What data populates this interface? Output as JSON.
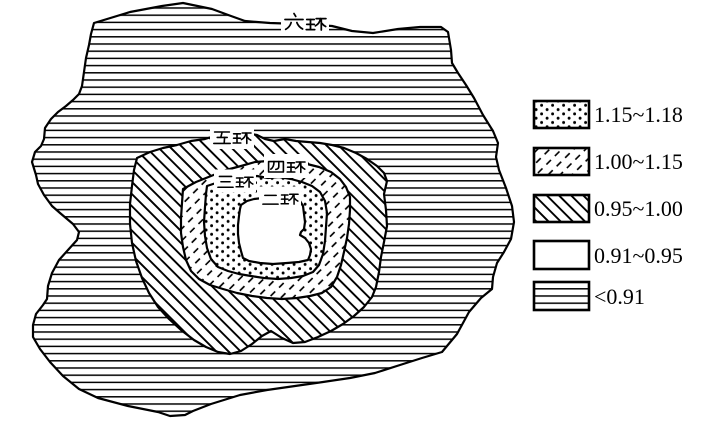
{
  "figure": {
    "type": "thematic-ring-road-map",
    "description": "Schematic map of concentric ring-road zones filled with hatch patterns keyed to a legend of value classes"
  },
  "map": {
    "ring_labels": [
      {
        "id": "ring-6",
        "label": "六环"
      },
      {
        "id": "ring-5",
        "label": "五环"
      },
      {
        "id": "ring-4",
        "label": "四环"
      },
      {
        "id": "ring-3",
        "label": "三环"
      },
      {
        "id": "ring-2",
        "label": "二环"
      }
    ],
    "zones": [
      {
        "area": "inside-ring6-outside-ring5",
        "pattern": "horizontal-lines",
        "value": "<0.91"
      },
      {
        "area": "ring5-to-ring4",
        "pattern": "backslash-hatch",
        "value": "0.95~1.00"
      },
      {
        "area": "ring4-to-ring3",
        "pattern": "slash-dash-hatch",
        "value": "1.00~1.15"
      },
      {
        "area": "ring3-to-ring2",
        "pattern": "dots",
        "value": "1.15~1.18"
      },
      {
        "area": "inside-ring2",
        "pattern": "plain-white",
        "value": "0.91~0.95"
      }
    ]
  },
  "legend": {
    "items": [
      {
        "pattern": "dots",
        "label": "1.15~1.18"
      },
      {
        "pattern": "slash-dash-hatch",
        "label": "1.00~1.15"
      },
      {
        "pattern": "backslash-hatch",
        "label": "0.95~1.00"
      },
      {
        "pattern": "plain-white",
        "label": "0.91~0.95"
      },
      {
        "pattern": "horizontal-lines",
        "label": "<0.91"
      }
    ]
  },
  "colors": {
    "ink": "#000000",
    "background": "#ffffff"
  }
}
